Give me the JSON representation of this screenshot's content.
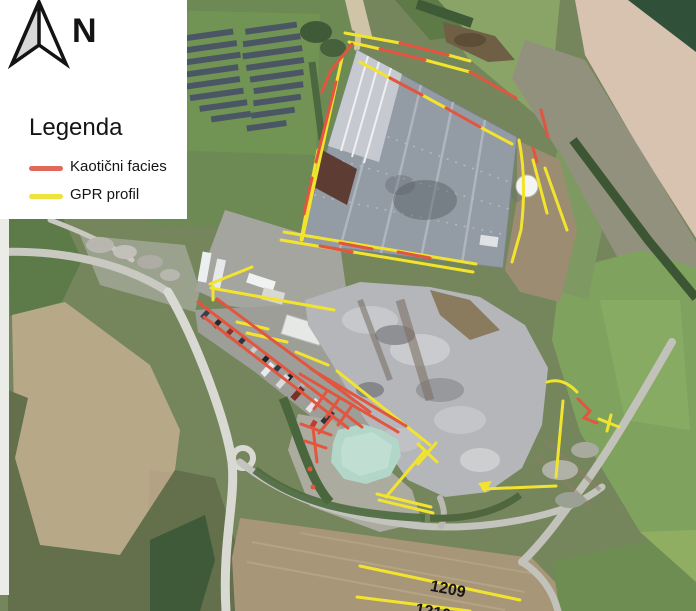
{
  "figure": {
    "type": "aerial-map-figure"
  },
  "north_arrow": {
    "label": "N"
  },
  "legend": {
    "title": "Legenda",
    "items": [
      {
        "label": "Kaotični facies",
        "color": "#e0695c"
      },
      {
        "label": "GPR profil",
        "color": "#efe23d"
      }
    ]
  },
  "map": {
    "profile_labels": [
      {
        "text": "1209"
      },
      {
        "text": "1210"
      }
    ]
  },
  "colors": {
    "facies_red": "#e2553f",
    "gpr_yellow": "#f2e42e",
    "legend_red": "#e0695c",
    "legend_yellow": "#efe23d"
  }
}
